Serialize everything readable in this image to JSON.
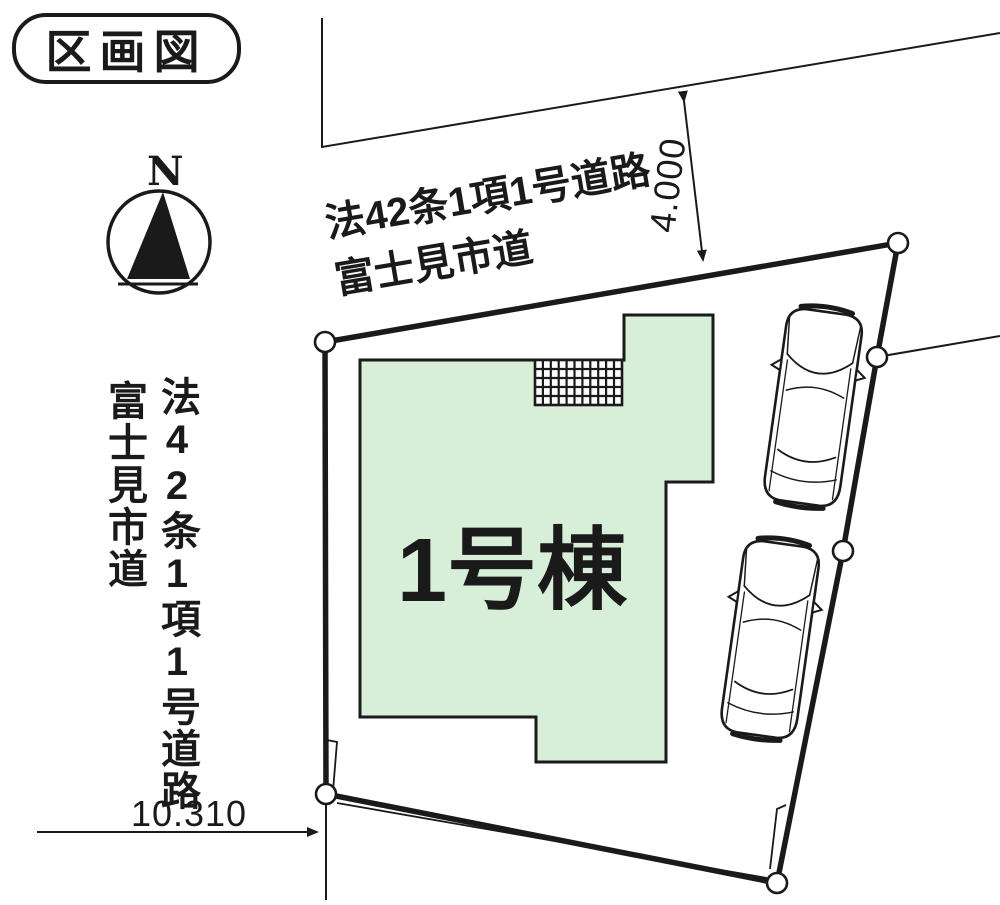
{
  "title": "区画図",
  "compass": {
    "north": "N"
  },
  "top_road": {
    "label_line1": "法42条1項1号道路",
    "label_line2": "富士見市道",
    "width_dimension": "4.000"
  },
  "left_road": {
    "label_line1": "法42条1項1号道路",
    "label_line2": "富士見市道"
  },
  "building": {
    "label": "1号棟"
  },
  "plot": {
    "south_dimension": "10.310"
  },
  "colors": {
    "ink": "#1a1a1a",
    "building_fill": "#d7eed8",
    "paper": "#ffffff"
  }
}
